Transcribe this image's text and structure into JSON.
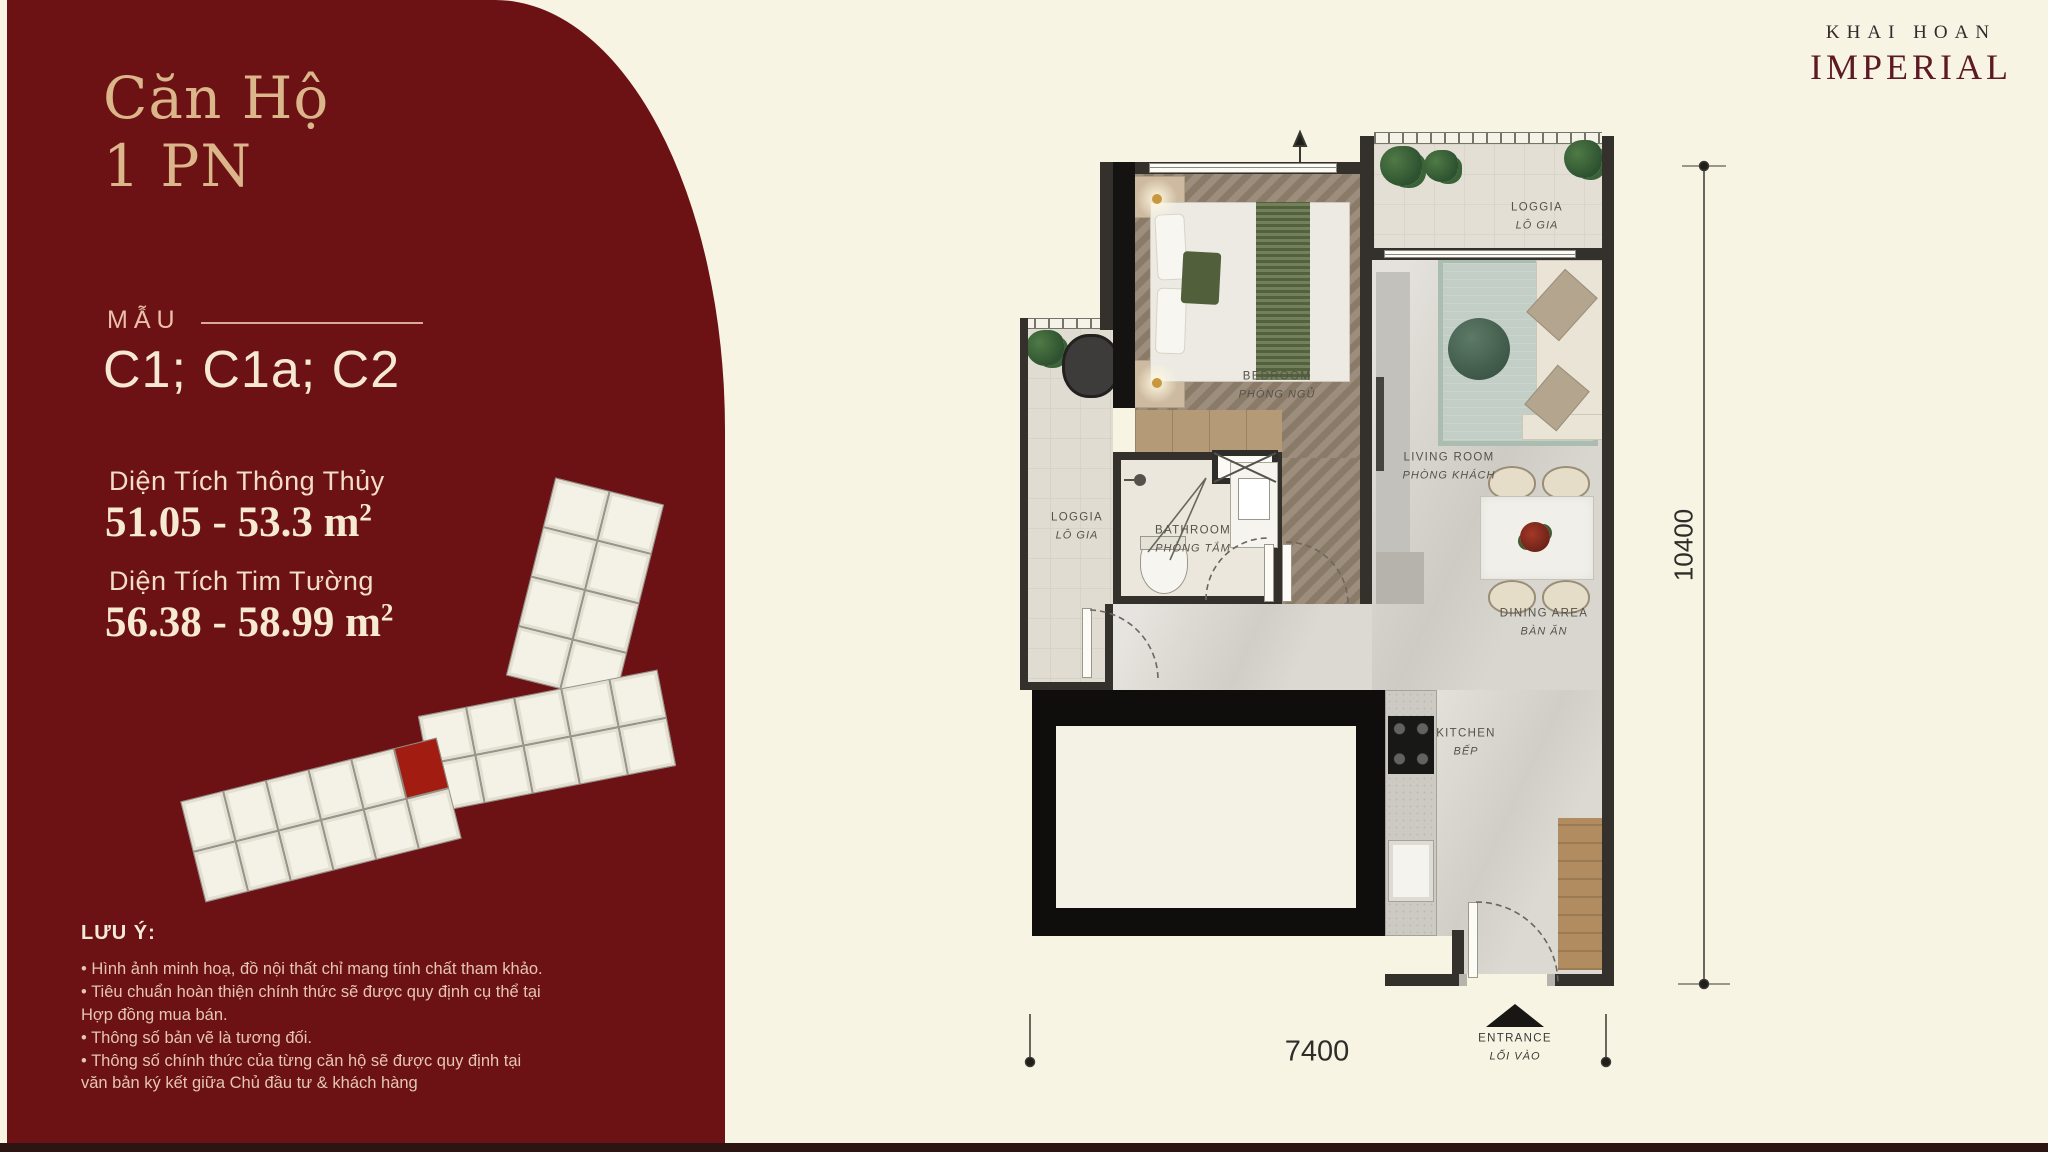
{
  "brand": {
    "line1": "KHAI HOAN",
    "line2": "IMPERIAL"
  },
  "sidebar": {
    "title_line1": "Căn Hộ",
    "title_line2": "1 PN",
    "model_label": "MẪU",
    "model_codes": "C1; C1a; C2",
    "areas": [
      {
        "label": "Diện Tích Thông Thủy",
        "value": "51.05 - 53.3",
        "unit": "m",
        "sup": "2"
      },
      {
        "label": "Diện Tích Tim Tường",
        "value": "56.38 - 58.99",
        "unit": "m",
        "sup": "2"
      }
    ],
    "notes_heading": "LƯU Ý:",
    "notes": [
      "• Hình ảnh minh hoạ, đồ nội thất chỉ mang tính chất tham khảo.",
      "• Tiêu chuẩn hoàn thiện chính thức sẽ được quy định cụ thể tại Hợp đồng mua bán.",
      "• Thông số bản vẽ là tương đối.",
      "• Thông số chính thức của từng căn hộ sẽ được quy định tại văn bản ký kết giữa Chủ đầu tư & khách hàng"
    ]
  },
  "plan": {
    "rooms": [
      {
        "en": "BEDROOM",
        "vi": "PHÒNG NGỦ"
      },
      {
        "en": "LOGGIA",
        "vi": "LÔ GIA"
      },
      {
        "en": "LOGGIA",
        "vi": "LÔ GIA"
      },
      {
        "en": "BATHROOM",
        "vi": "PHÒNG TẮM"
      },
      {
        "en": "LIVING ROOM",
        "vi": "PHÒNG KHÁCH"
      },
      {
        "en": "DINING AREA",
        "vi": "BÀN ĂN"
      },
      {
        "en": "KITCHEN",
        "vi": "BẾP"
      },
      {
        "en": "ENTRANCE",
        "vi": "LỐI VÀO"
      }
    ],
    "dimensions": {
      "height": "10400",
      "width": "7400"
    }
  },
  "colors": {
    "panel_red": "#6d1214",
    "accent_gold": "#dcb68b",
    "highlight_unit": "#a31c12",
    "background_cream": "#f8f4e4"
  }
}
